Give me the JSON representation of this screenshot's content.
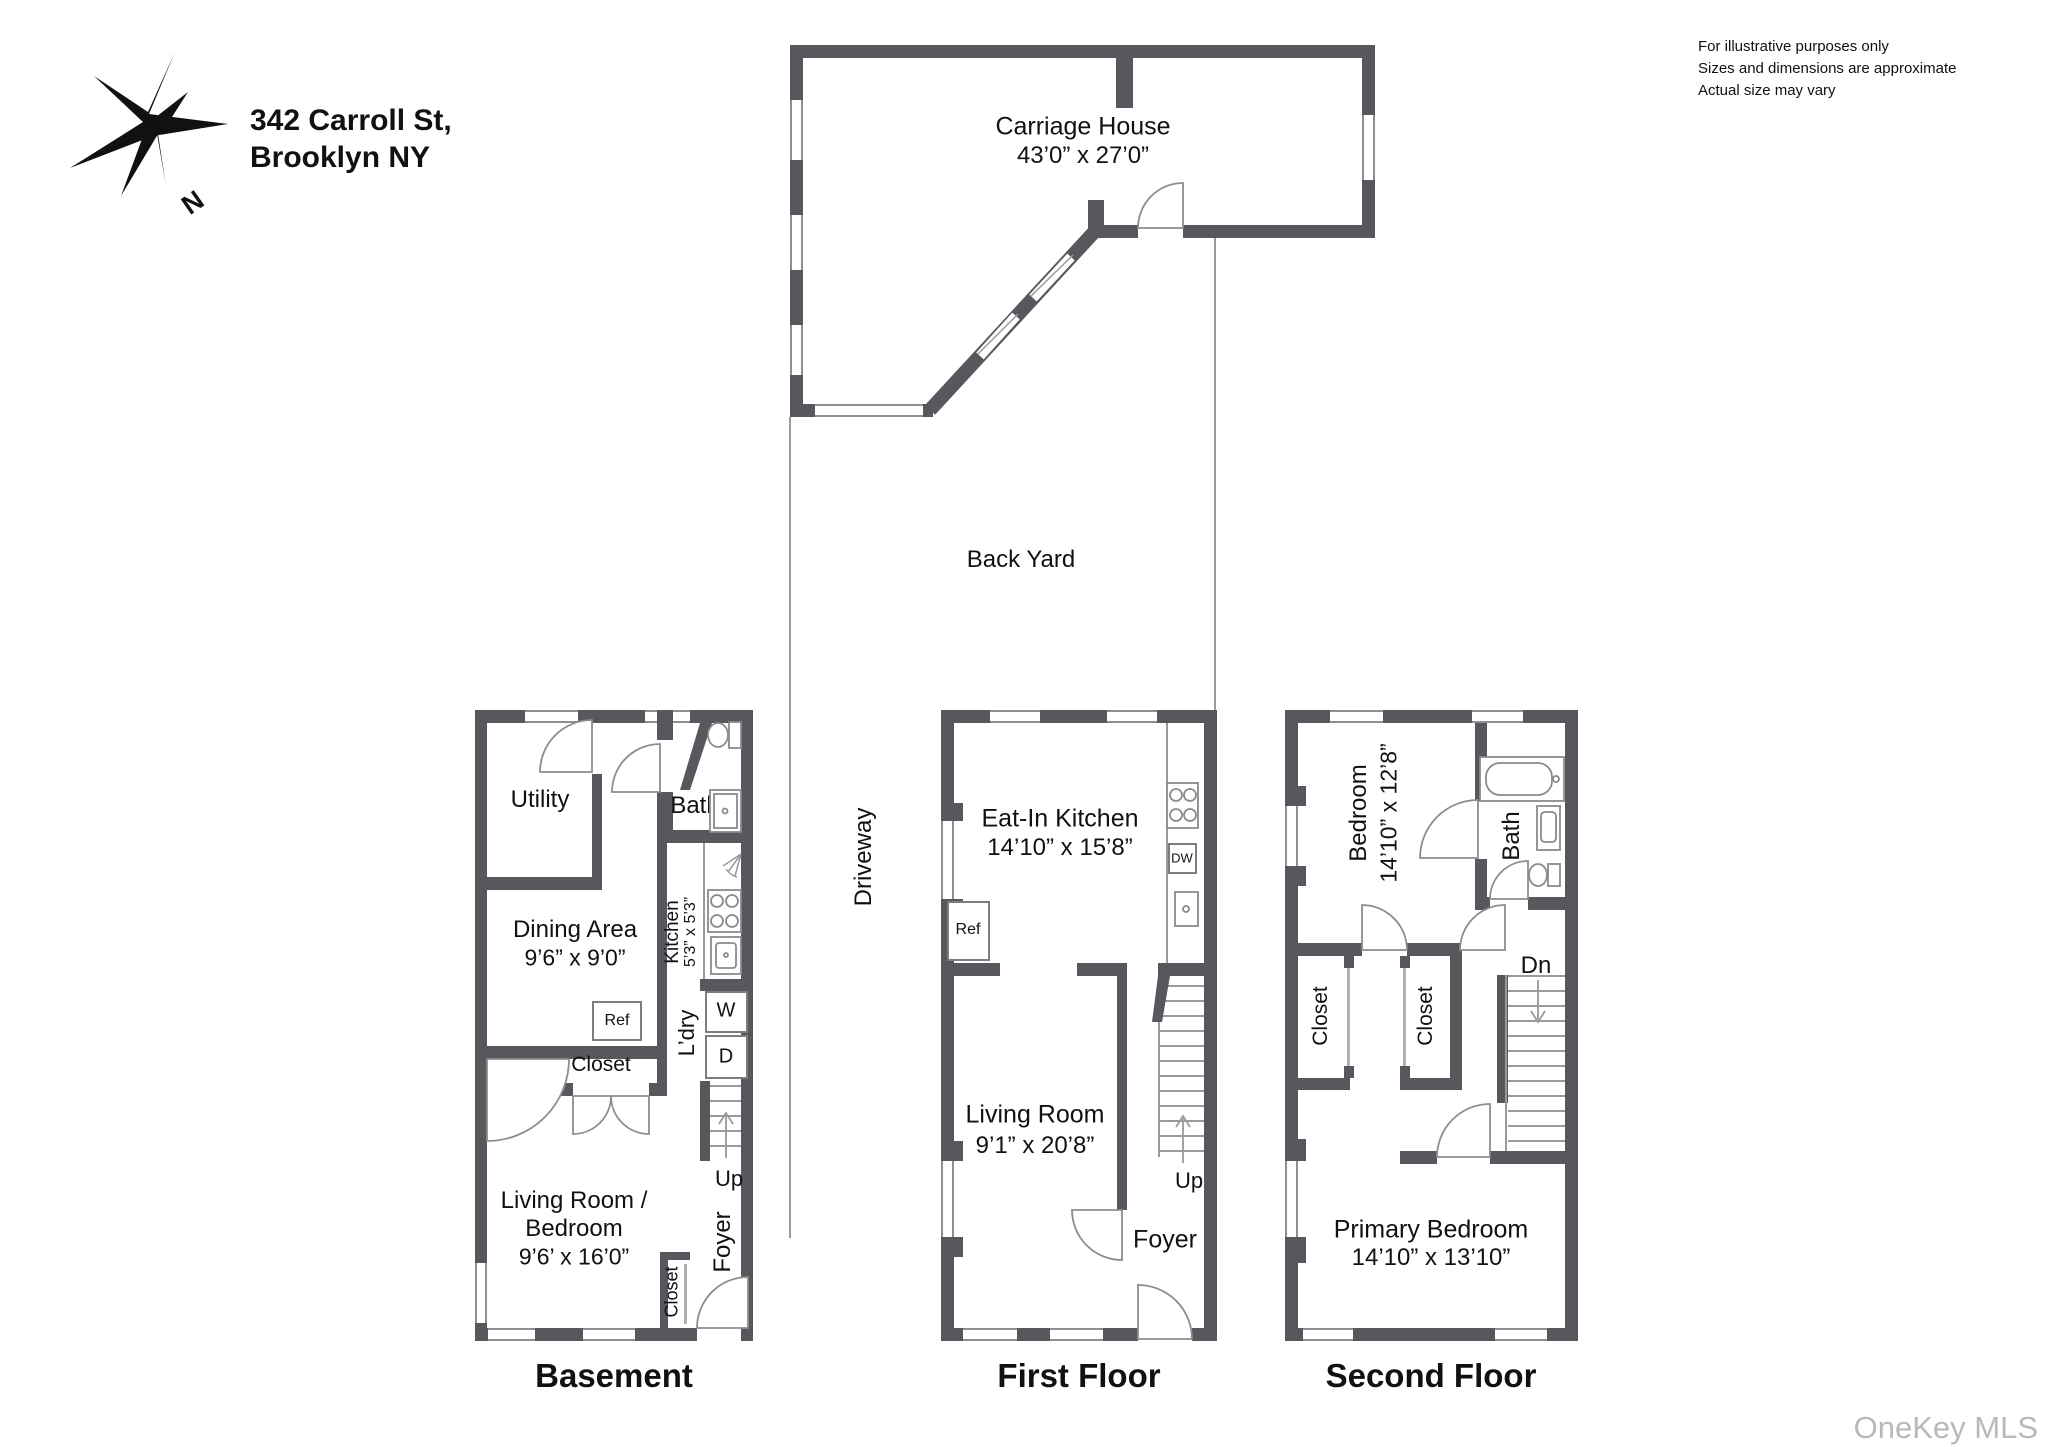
{
  "header": {
    "address_line1": "342 Carroll St,",
    "address_line2": "Brooklyn NY"
  },
  "disclaimer": {
    "line1": "For illustrative purposes only",
    "line2": "Sizes and dimensions are approximate",
    "line3": "Actual size may vary"
  },
  "compass": {
    "north_label": "N"
  },
  "site": {
    "carriage_house_name": "Carriage House",
    "carriage_house_dims": "43’0” x 27’0”",
    "back_yard": "Back Yard",
    "driveway": "Driveway"
  },
  "basement": {
    "title": "Basement",
    "utility": "Utility",
    "bath": "Bath",
    "kitchen_label": "Kitchen",
    "kitchen_dims": "5’3” x 5’3”",
    "dining_label": "Dining Area",
    "dining_dims": "9’6” x 9’0”",
    "ref": "Ref",
    "closet_mid": "Closet",
    "ldry": "L’dry",
    "washer": "W",
    "dryer": "D",
    "up": "Up",
    "living_line1": "Living Room /",
    "living_line2": "Bedroom",
    "living_dims": "9’6’ x 16’0”",
    "closet_bottom": "Closet",
    "foyer": "Foyer"
  },
  "first_floor": {
    "title": "First Floor",
    "kitchen_label": "Eat-In Kitchen",
    "kitchen_dims": "14’10” x 15’8”",
    "ref": "Ref",
    "dw": "DW",
    "living_label": "Living Room",
    "living_dims": "9’1” x 20’8”",
    "up": "Up",
    "foyer": "Foyer"
  },
  "second_floor": {
    "title": "Second Floor",
    "bedroom_label": "Bedroom",
    "bedroom_dims": "14’10” x 12’8”",
    "bath": "Bath",
    "closet_left": "Closet",
    "closet_right": "Closet",
    "dn": "Dn",
    "primary_label": "Primary Bedroom",
    "primary_dims": "14’10” x 13’10”"
  },
  "watermark": "OneKey MLS"
}
